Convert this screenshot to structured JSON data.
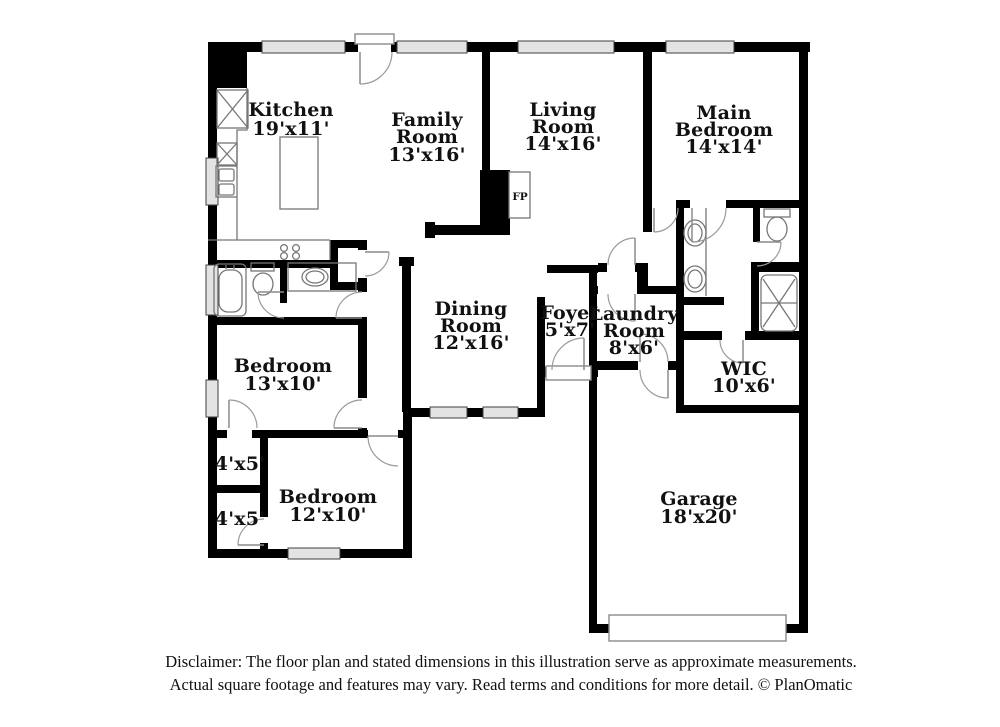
{
  "plan": {
    "rooms": {
      "kitchen": {
        "lines": [
          "Kitchen",
          "19'x11'"
        ]
      },
      "family_room": {
        "lines": [
          "Family",
          "Room",
          "13'x16'"
        ]
      },
      "living_room": {
        "lines": [
          "Living",
          "Room",
          "14'x16'"
        ]
      },
      "main_bedroom": {
        "lines": [
          "Main",
          "Bedroom",
          "14'x14'"
        ]
      },
      "dining_room": {
        "lines": [
          "Dining",
          "Room",
          "12'x16'"
        ]
      },
      "foyer": {
        "lines": [
          "Foyer",
          "5'x7'"
        ]
      },
      "laundry_room": {
        "lines": [
          "Laundry",
          "Room",
          "8'x6'"
        ]
      },
      "wic": {
        "lines": [
          "WIC",
          "10'x6'"
        ]
      },
      "bedroom_left": {
        "lines": [
          "Bedroom",
          "13'x10'"
        ]
      },
      "bedroom_bottom": {
        "lines": [
          "Bedroom",
          "12'x10'"
        ]
      },
      "closet_top": {
        "lines": [
          "4'x5'"
        ]
      },
      "closet_bottom": {
        "lines": [
          "4'x5'"
        ]
      },
      "garage": {
        "lines": [
          "Garage",
          "18'x20'"
        ]
      },
      "fireplace": {
        "label": "FP"
      }
    },
    "disclaimer": {
      "line1": "Disclaimer: The floor plan and stated dimensions in this illustration serve as approximate measurements.",
      "line2": "Actual square footage and features may vary. Read terms and conditions for more detail. © PlanOmatic"
    },
    "colors": {
      "wall": "#000000",
      "window": "#e3e3e3",
      "fixture": "#777777",
      "text": "#111111"
    }
  }
}
